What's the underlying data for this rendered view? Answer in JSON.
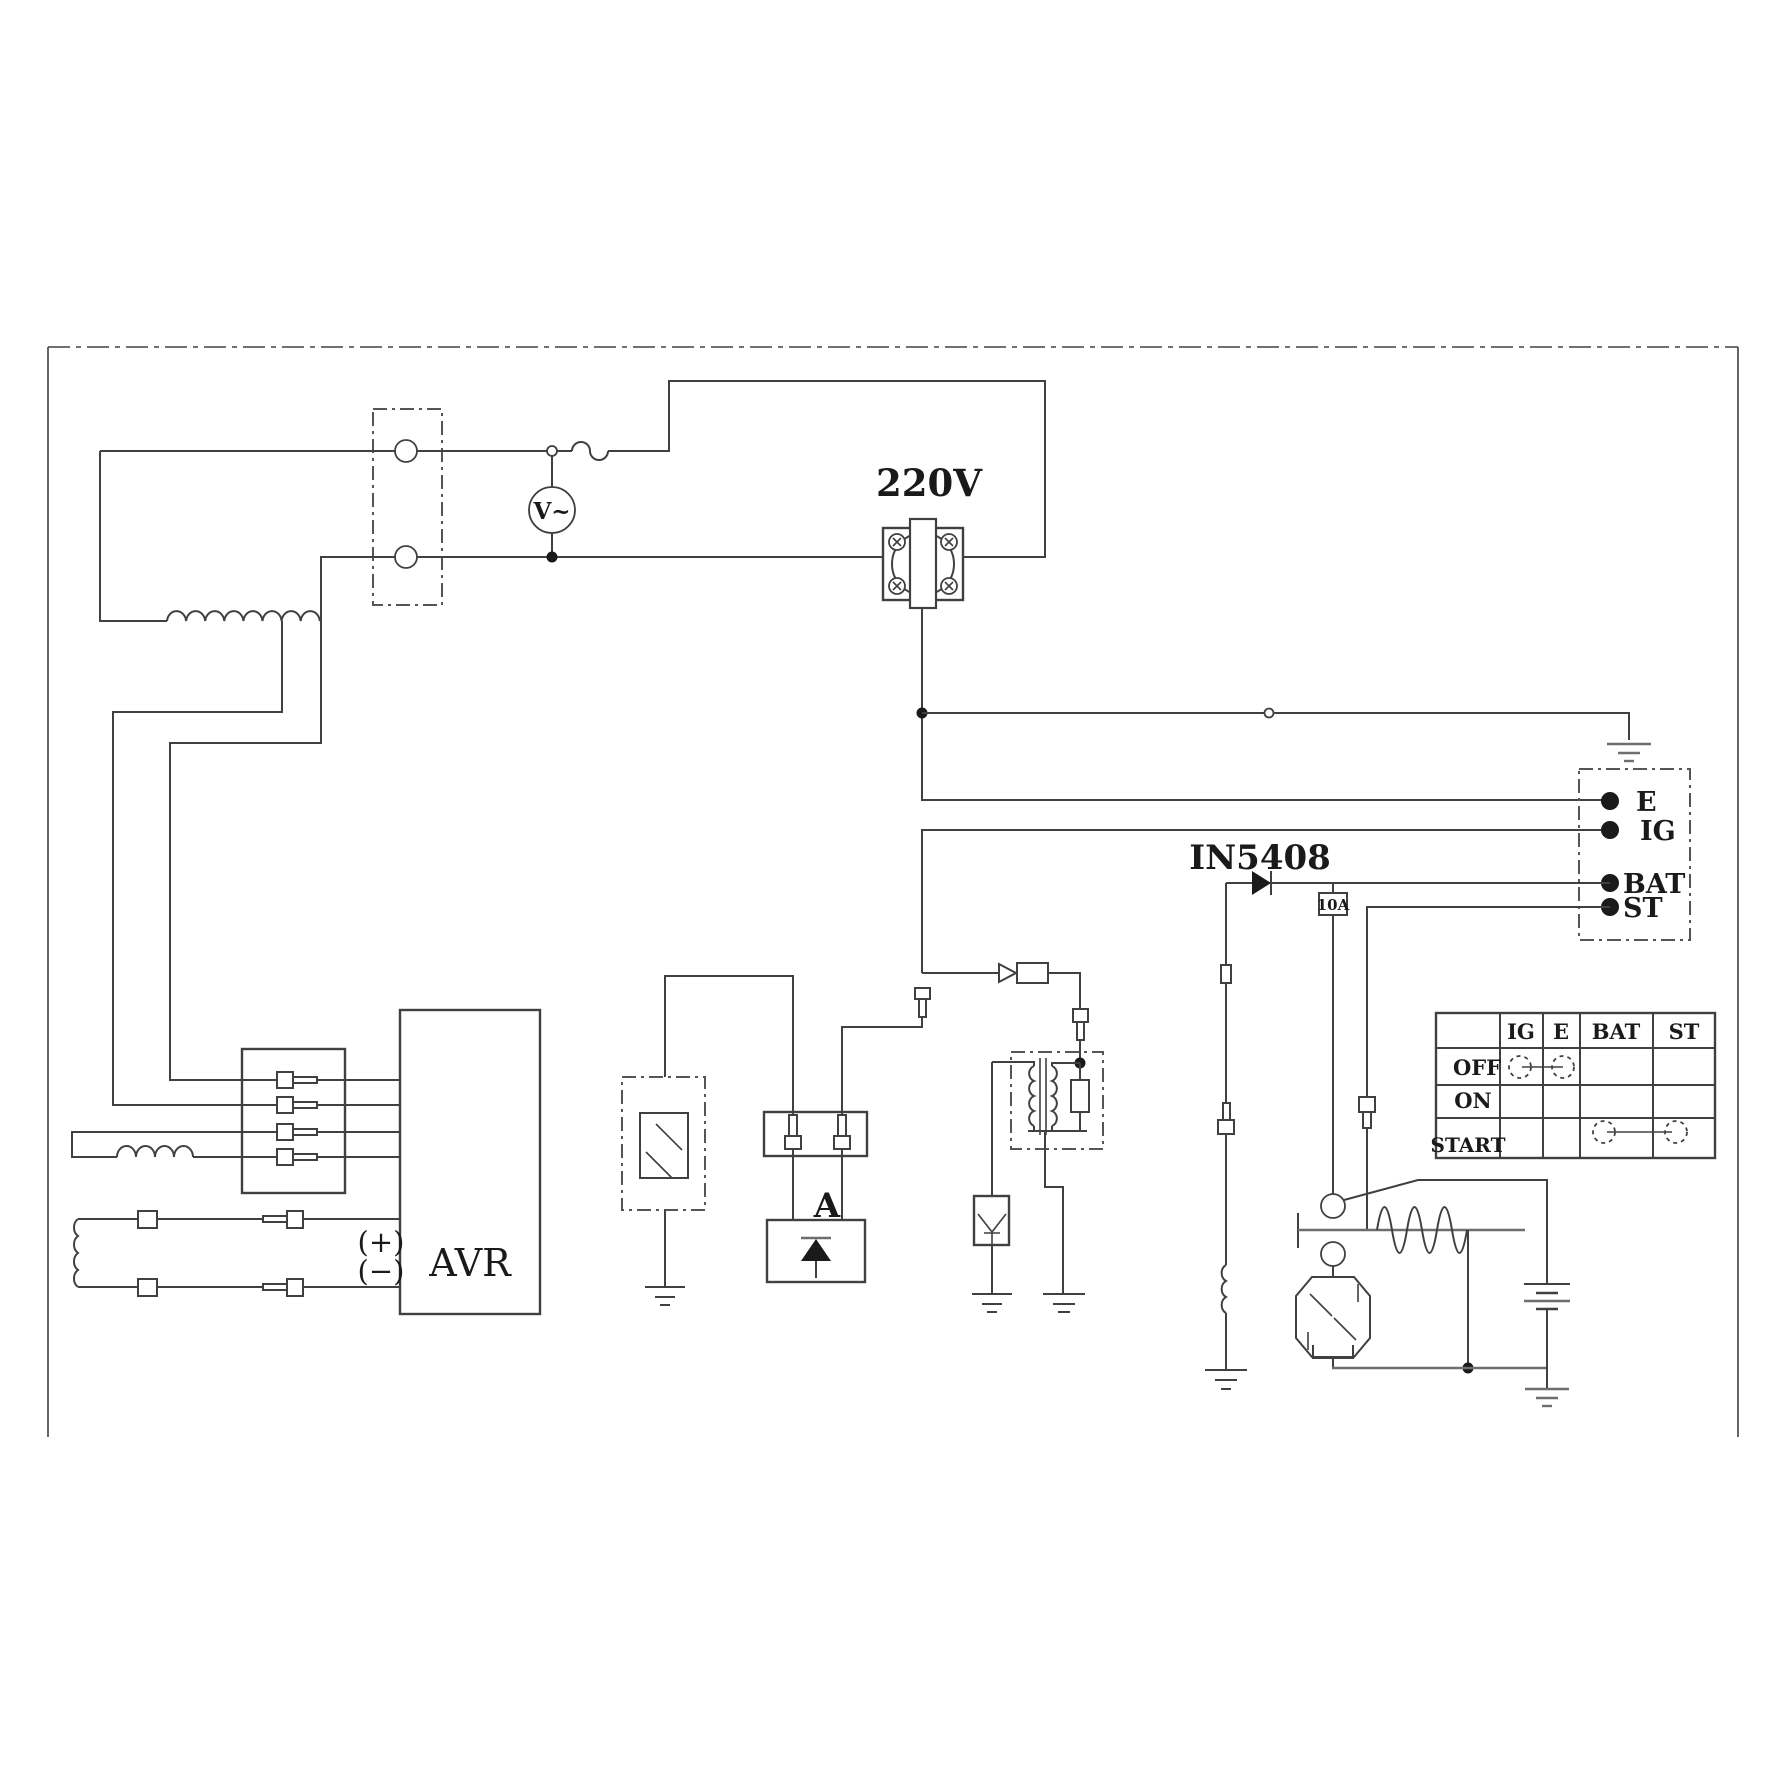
{
  "labels": {
    "voltage": "220V",
    "diode": "IN5408",
    "fuse": "10A",
    "unit_a": "A",
    "avr": "AVR",
    "plus": "(+)",
    "minus": "(−)",
    "voltmeter": "V~"
  },
  "key_terminals": {
    "e": "E",
    "ig": "IG",
    "bat": "BAT",
    "st": "ST"
  },
  "switch_table": {
    "headers": [
      "IG",
      "E",
      "BAT",
      "ST"
    ],
    "rows": [
      "OFF",
      "ON",
      "START"
    ],
    "connections": [
      {
        "position": "OFF",
        "from": "IG",
        "to": "E"
      },
      {
        "position": "START",
        "from": "BAT",
        "to": "ST"
      }
    ]
  },
  "colors": {
    "line": "#404040",
    "text": "#1a1a1a",
    "background": "#ffffff"
  }
}
